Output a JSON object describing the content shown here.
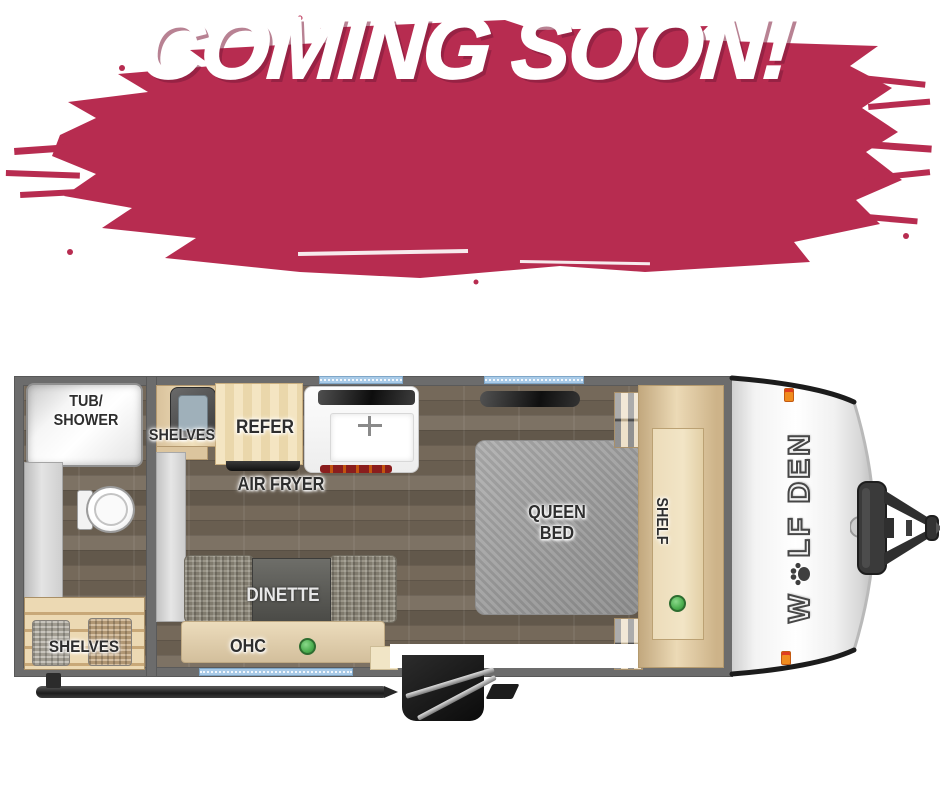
{
  "banner": {
    "text": "COMING SOON!",
    "brush_color": "#b72c50",
    "text_color": "#ffffff",
    "shadow_color": "#7e1b3b"
  },
  "floorplan": {
    "colors": {
      "wall": "#6c6c6c",
      "window_blue": "#a9cbe8",
      "indicator_green": "#4cae4f",
      "wood_floor": "#71675a",
      "cabinet_wood": "#e6d2ae",
      "bed_gray": "#a3a3a3",
      "front_cap": "#ffffff",
      "marker_light": "#f08c1e"
    },
    "bathroom": {
      "tub_line1": "TUB/",
      "tub_line2": "SHOWER",
      "shelves": "SHELVES"
    },
    "kitchen": {
      "shelves": "SHELVES",
      "refer": "REFER",
      "air_fryer": "AIR FRYER"
    },
    "living": {
      "dinette": "DINETTE",
      "ohc": "OHC"
    },
    "bedroom": {
      "queen_line1": "QUEEN",
      "queen_line2": "BED",
      "shelf": "SHELF"
    },
    "brand": {
      "pre": "W",
      "post": "LF DEN"
    }
  }
}
